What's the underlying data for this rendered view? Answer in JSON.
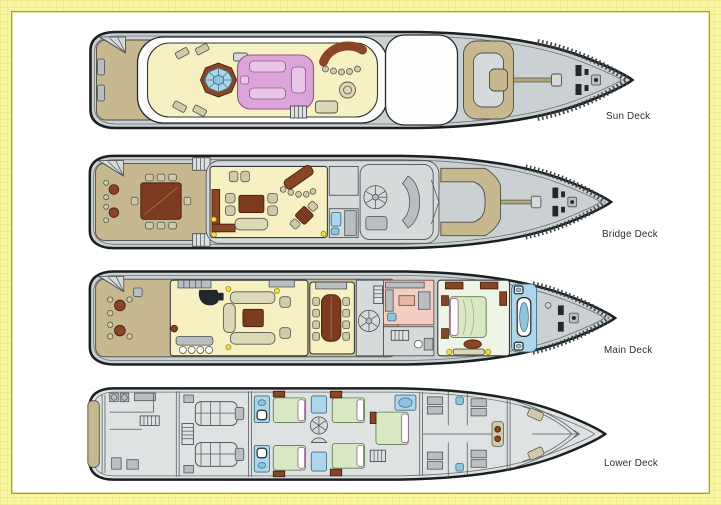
{
  "page": {
    "background_color": "#f8f5a0",
    "panel_color": "#ffffff",
    "panel_border_color": "#97978c"
  },
  "decks": [
    {
      "label": "Sun Deck"
    },
    {
      "label": "Bridge Deck"
    },
    {
      "label": "Main Deck"
    },
    {
      "label": "Lower Deck"
    }
  ],
  "palette": {
    "hull_gray": "#cbd0d2",
    "teak_tan": "#c7b88f",
    "interior_yellow": "#f6f0c2",
    "sunpad_pink": "#dca4d8",
    "jacuzzi_blue": "#bfe2ef",
    "wood_brown": "#8a4527",
    "bed_green": "#d8e8c2",
    "stateroom_green": "#eef4e6",
    "bath_blue": "#aed6ea",
    "galley_salmon": "#f3cfc3",
    "lamp_yellow": "#f5df3d",
    "hardtop_white": "#fdfdfc"
  }
}
